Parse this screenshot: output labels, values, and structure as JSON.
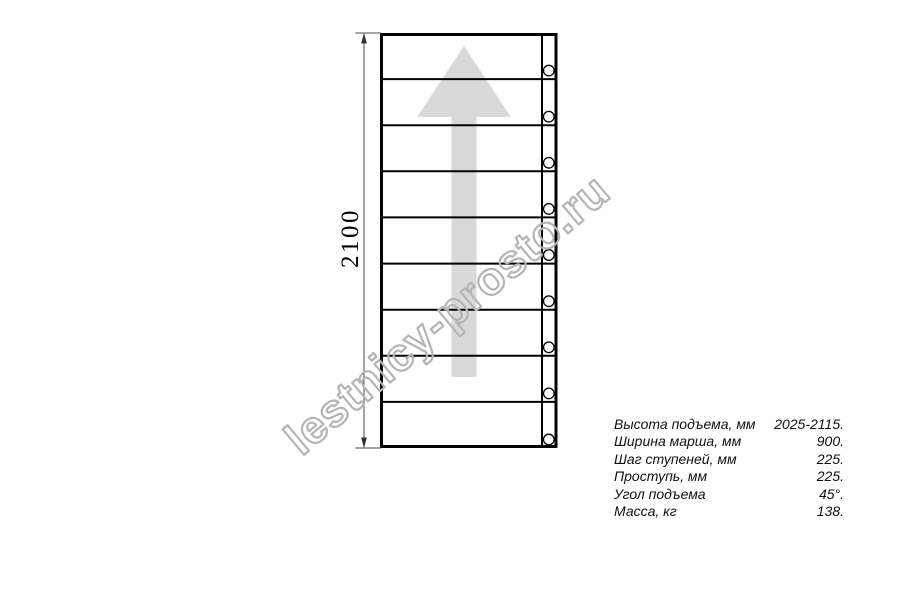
{
  "page": {
    "background": "#ffffff"
  },
  "drawing": {
    "dimension_label": "2100",
    "treads_count": 9,
    "line_color": "#000000",
    "dimension_line_color": "#4a4a4a",
    "arrow_color": "#d9d9d9",
    "arrow_direction": "up"
  },
  "watermark": {
    "text": "lestnicy-prosto.ru",
    "color": "#b5b5b5"
  },
  "specs": {
    "rows": [
      {
        "label": "Высота подъема, мм",
        "value": "2025-2115."
      },
      {
        "label": "Ширина марша, мм",
        "value": "900."
      },
      {
        "label": "Шаг ступеней, мм",
        "value": "225."
      },
      {
        "label": "Проступь, мм",
        "value": "225."
      },
      {
        "label": "Угол подъема",
        "value": "45°."
      },
      {
        "label": "Масса, кг",
        "value": "138."
      }
    ]
  }
}
